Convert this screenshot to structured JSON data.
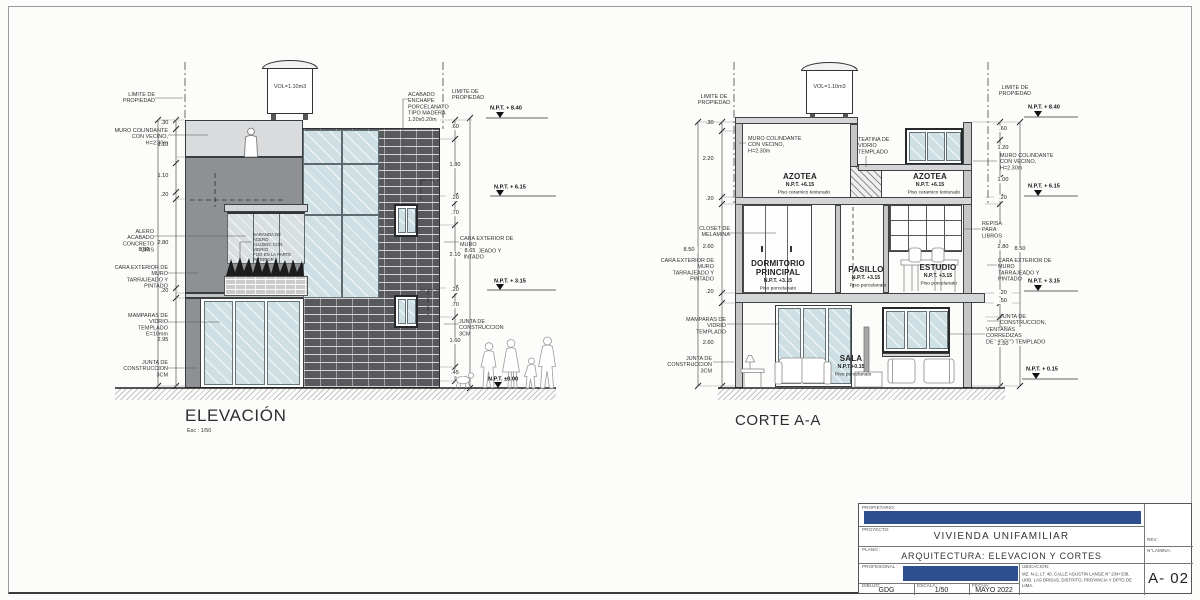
{
  "sheet": {
    "title_elevation": "ELEVACIÓN",
    "elevation_scale": "Esc : 1/50",
    "title_corte": "CORTE A-A"
  },
  "colors": {
    "redaction_blue": "#2d4e8f",
    "brick_wall": "#57595d",
    "glass": "#cfe0e4",
    "mid_wall": "#8e9194",
    "light_slab": "#dadbdc"
  },
  "elevation": {
    "tank_volume": "VOL=1.10m3",
    "baranda": "BARANDA DE ACERO\nALUZINC CON VIDRIO\nFIJO EN LA PARTE\nINTERIOR",
    "left": {
      "limite": "LIMITE DE\nPROPIEDAD",
      "muro_colindante": "MURO COLINDANTE\nCON VECINO, H=2.30m",
      "alero": "ALERO ACABADO\nCONCRETO GRIS",
      "cara_exterior": "CARA EXTERIOR DE MURO\nTARRAJEADO Y PINTADO",
      "mamparas": "MAMPARAS DE\nVIDRIO TEMPLADO\nE=10mm",
      "junta": "JUNTA DE CONSTRUCCION\n3CM",
      "dims": {
        "d1": ".30",
        "d2": "1.10",
        "d3": "1.10",
        "d4": ".20",
        "d5": "2.80",
        "d6": ".20",
        "d7": "2.95",
        "total": "8.50"
      }
    },
    "right": {
      "acabado": "ACABADO\nENCHAPE PORCELANATO\nTIPO MADERA 1.20x0.20m",
      "limite": "LIMITE DE\nPROPIEDAD",
      "npt_840": "N.P.T. + 8.40",
      "npt_615": "N.P.T. + 6.15",
      "npt_315": "N.P.T. + 3.15",
      "npt_000": "N.P.T. ±0.00",
      "cara_exterior": "CARA EXTERIOR DE MURO\nTARRAJEADO Y PINTADO",
      "junta": "JUNTA DE CONSTRUCCION\n3CM",
      "dims": {
        "d1": ".60",
        "d2": "1.80",
        "d3": ".20",
        "d4": ".70",
        "d5": "2.10",
        "d6": ".20",
        "d7": ".70",
        "d8": "1.60",
        "d9": ".45",
        "total": "8.65"
      }
    }
  },
  "corte": {
    "tank_volume": "VOL=1.10m3",
    "teatina": "TEATINA DE\nVIDRIO TEMPLADO",
    "rooms": {
      "azotea_left": {
        "name": "AZOTEA",
        "npt": "N.P.T. +6.15",
        "floor": "Piso ceramico texturado"
      },
      "azotea_right": {
        "name": "AZOTEA",
        "npt": "N.P.T. +6.15",
        "floor": "Piso ceramico texturado"
      },
      "dormitorio": {
        "name": "DORMITORIO\nPRINCIPAL",
        "npt": "N.P.T. +3.15",
        "floor": "Piso porcelanato"
      },
      "pasillo": {
        "name": "PASILLO",
        "npt": "N.P.T. +3.15",
        "floor": "Piso porcelanato"
      },
      "estudio": {
        "name": "ESTUDIO",
        "npt": "N.P.T. +3.15",
        "floor": "Piso porcelanato"
      },
      "sala": {
        "name": "SALA",
        "npt": "N.P.T.+0.15",
        "floor": "Piso porcelanato"
      }
    },
    "left": {
      "limite": "LIMITE DE\nPROPIEDAD",
      "muro_colindante": "MURO COLINDANTE\nCON VECINO, H=2.30m",
      "closet": "CLOSET DE\nMELAMINA",
      "cara_exterior": "CARA EXTERIOR DE MURO\nTARRAJEADO Y PINTADO",
      "mamparas": "MAMPARAS DE\nVIDRIO TEMPLADO",
      "junta": "JUNTA DE CONSTRUCCION\n3CM",
      "dims": {
        "d1": ".30",
        "d2": "2.20",
        "d3": ".20",
        "d4": "2.60",
        "d5": ".20",
        "d6": "2.60",
        "total": "8.50"
      }
    },
    "right": {
      "limite": "LIMITE DE\nPROPIEDAD",
      "npt_840": "N.P.T. + 8.40",
      "muro_colindante": "MURO COLINDANTE\nCON VECINO, H=2.30m",
      "npt_615": "N.P.T. + 6.15",
      "repisa": "REPISA\nPARA LIBROS",
      "cara_exterior": "CARA EXTERIOR DE MURO\nTARRAJEADO Y PINTADO",
      "npt_315": "N.P.T. + 3.15",
      "junta": "JUNTA DE CONSTRUCCION,\n3CM",
      "ventanas": "VENTANAS CORREDIZAS\nDE VIDRIO TEMPLADO",
      "npt_015": "N.P.T. + 0.15",
      "dims": {
        "d1": ".60",
        "d2": "1.20",
        "d3": "1.00",
        "d4": ".20",
        "d5": "2.80",
        "d6": ".20",
        "d7": ".50",
        "d8": "2.50",
        "total": "8.50"
      }
    }
  },
  "titleblock": {
    "propietario_label": "PROPIETARIO:",
    "proyecto_label": "PROYECTO:",
    "proyecto": "VIVIENDA UNIFAMILIAR",
    "plano_label": "PLANO :",
    "plano": "ARQUITECTURA: ELEVACION Y CORTES",
    "profesional_label": "PROFESIONAL :",
    "ubicacion_label": "UBICACION:",
    "ubicacion": "MZ. N-2, LT. 40, CALLE AGUSTIN LANGE N° 234+238,\nURB. LAS BRISAS, DISTRITO, PROVINCIA Y DPTO DE LIMA.",
    "dibujo_label": "DIBUJO:",
    "dibujo": "GDG",
    "escala_label": "ESCALA:",
    "escala": "1/50",
    "fecha_label": "FECHA:",
    "fecha": "MAYO 2022",
    "rev_label": "REV:",
    "lamina_label": "N°LAMINA:",
    "lamina": "A- 02"
  }
}
